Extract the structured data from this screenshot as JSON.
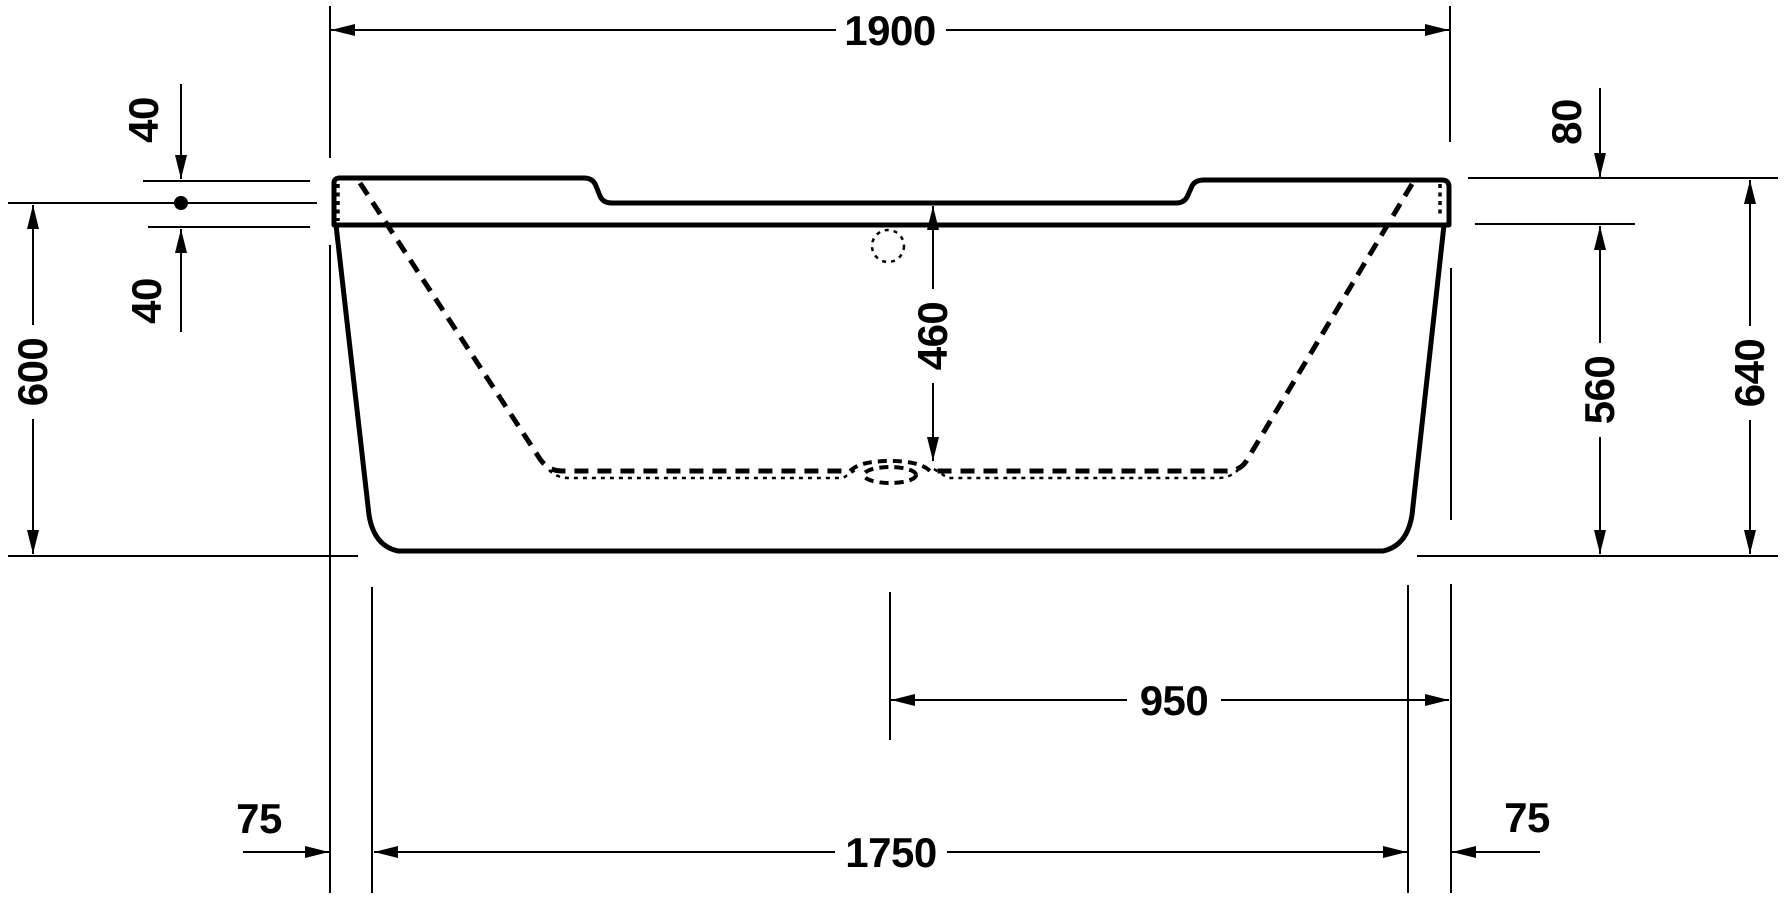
{
  "drawing": {
    "title": "Bathtub side elevation technical drawing",
    "background_color": "#ffffff",
    "line_color": "#000000",
    "labels": {
      "overall_length": "1900",
      "rim_offset_upper": "40",
      "rim_offset_lower": "40",
      "height_datum_to_floor": "600",
      "interior_depth": "460",
      "skirt_height": "560",
      "overall_height": "640",
      "rim_band_height": "80",
      "drain_to_right_edge": "950",
      "base_length": "1750",
      "base_inset_left": "75",
      "base_inset_right": "75"
    }
  }
}
